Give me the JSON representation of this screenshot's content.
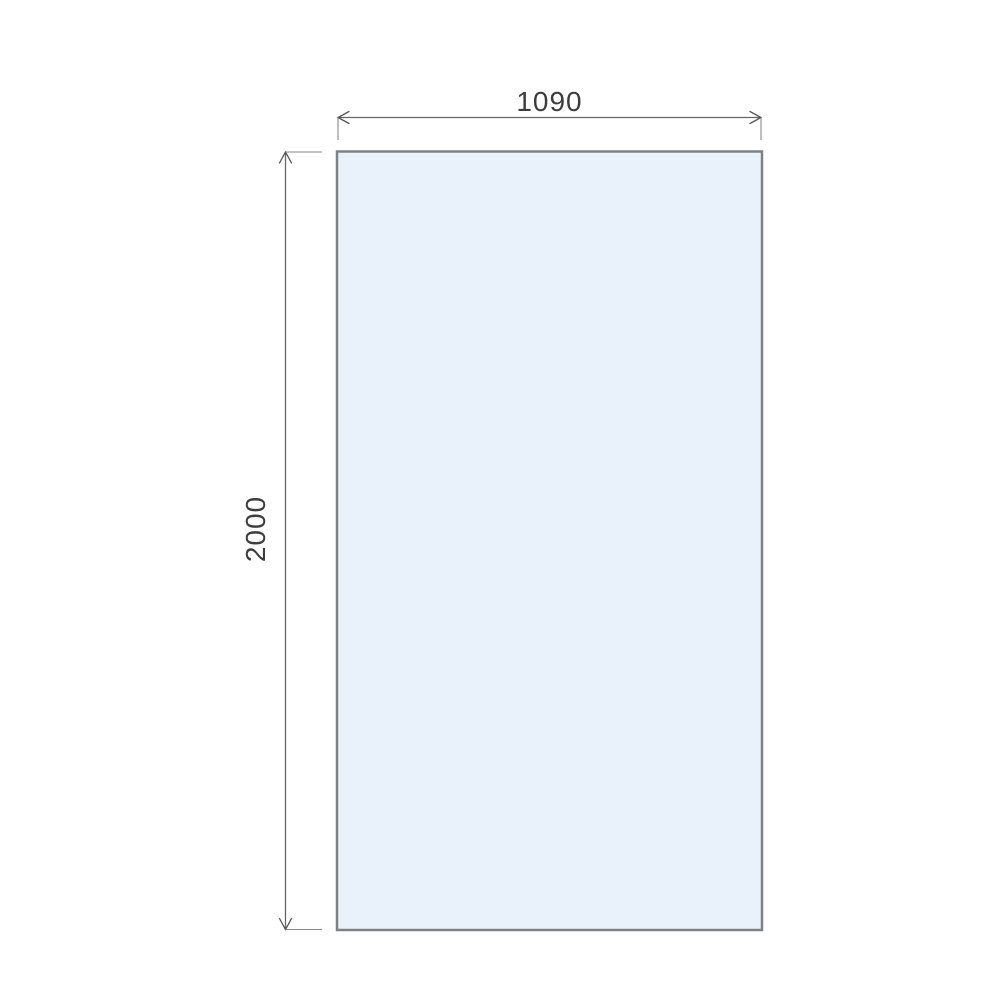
{
  "drawing": {
    "type": "dimensioned-panel-drawing",
    "width_dimension": {
      "value": "1090"
    },
    "height_dimension": {
      "value": "2000"
    },
    "colors": {
      "background": "#ffffff",
      "panel_fill": "#e9f1fb",
      "panel_border": "#7d8287",
      "dimension_line": "#666666",
      "dimension_text": "#3d3d3d"
    }
  }
}
